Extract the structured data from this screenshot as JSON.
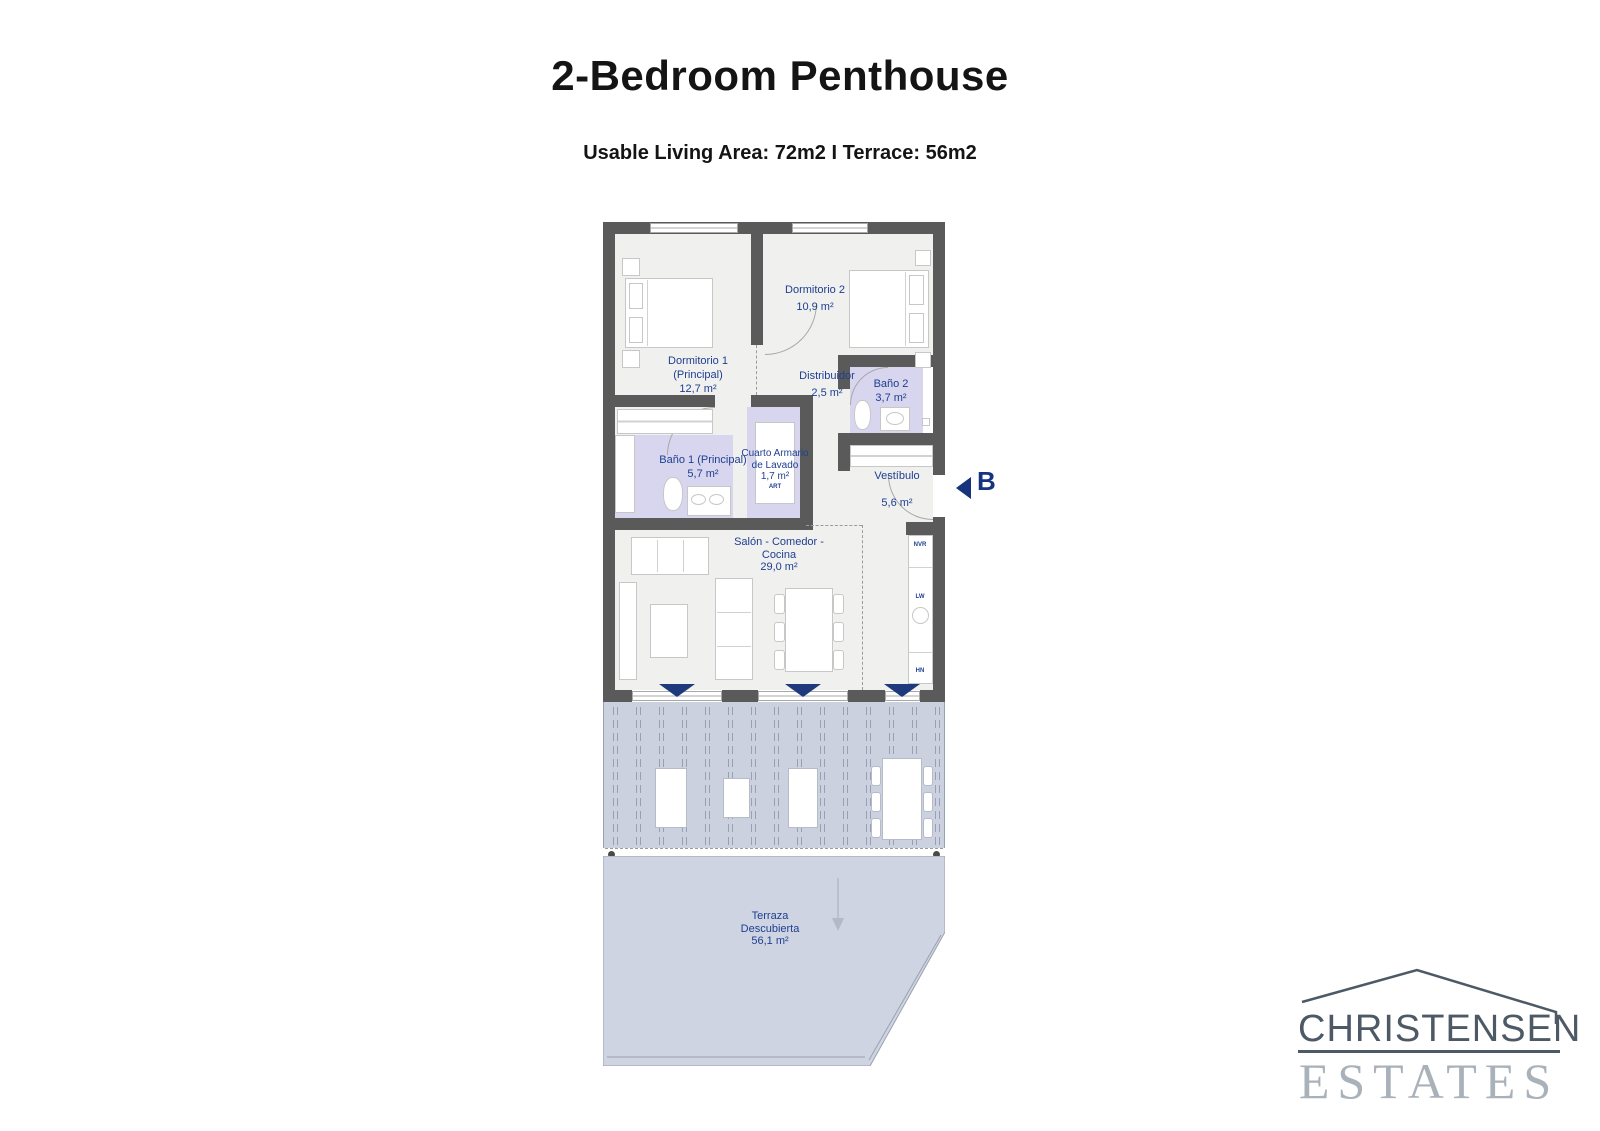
{
  "header": {
    "title": "2-Bedroom Penthouse",
    "subtitle": "Usable Living Area: 72m2 I Terrace: 56m2"
  },
  "plan": {
    "rooms": {
      "dormitorio1": {
        "line1": "Dormitorio 1",
        "line2": "(Principal)",
        "area": "12,7 m²"
      },
      "dormitorio2": {
        "name": "Dormitorio 2",
        "area": "10,9 m²"
      },
      "distribuidor": {
        "name": "Distribuidor",
        "area": "2,5 m²"
      },
      "bano2": {
        "name": "Baño 2",
        "area": "3,7 m²"
      },
      "bano1": {
        "name": "Baño 1 (Principal)",
        "area": "5,7 m²"
      },
      "lavado": {
        "line1": "Cuarto Armario",
        "line2": "de Lavado",
        "area": "1,7 m²",
        "appliance": "ART"
      },
      "vestibulo": {
        "name": "Vestíbulo",
        "area": "5,6 m²"
      },
      "salon": {
        "line1": "Salón - Comedor -",
        "line2": "Cocina",
        "area": "29,0 m²"
      },
      "terraza": {
        "line1": "Terraza",
        "line2": "Descubierta",
        "area": "56,1 m²"
      }
    },
    "entrance_label": "B",
    "kitchen": {
      "appliances": [
        "NVR",
        "LW",
        "HN"
      ]
    }
  },
  "logo": {
    "name": "CHRISTENSEN",
    "type": "ESTATES"
  },
  "colors": {
    "wall_gray": "#5a5a5a",
    "room_floor": "#f0f0ef",
    "bath_lavender": "#d8d6ef",
    "terrace_blue": "#ccd1e0",
    "label_blue": "#1e3e8f",
    "marker_navy": "#1e3a7d",
    "logo_dark": "#4d5a66",
    "logo_light": "#a9b2ba"
  }
}
